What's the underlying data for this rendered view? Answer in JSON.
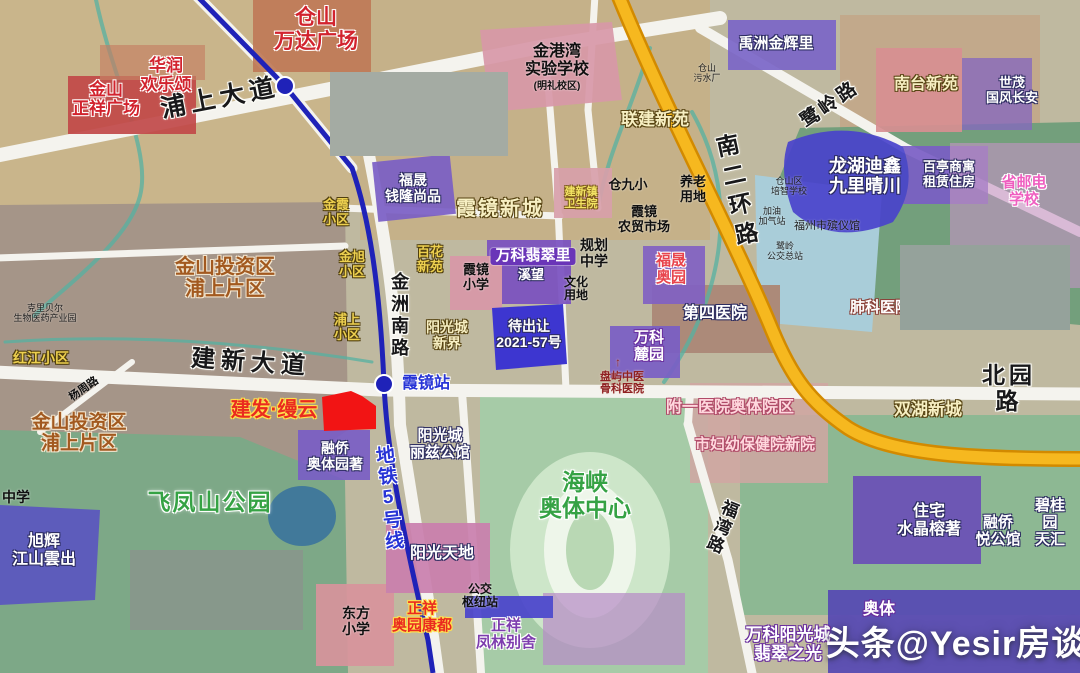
{
  "map": {
    "watermark": "头条@Yesir房谈",
    "colors": {
      "ring_road_orange": "#f6b81f",
      "metro_line_blue": "#1f22b8",
      "highlight_parcel_red": "#f21414",
      "auction_parcel_blue": "#3d36d0"
    },
    "labels": [
      {
        "name": "road-label-pushang-avenue",
        "text": "浦上大道",
        "x": 220,
        "y": 84,
        "size": 25,
        "style": "road",
        "rot": -11,
        "sp": 5
      },
      {
        "name": "road-label-jianxin-avenue",
        "text": "建新大道",
        "x": 251,
        "y": 350,
        "size": 24,
        "style": "road",
        "rot": 4,
        "sp": 6
      },
      {
        "name": "road-label-beiyuan",
        "text": "北园路",
        "x": 1009,
        "y": 363,
        "size": 23,
        "style": "road",
        "sp": 4
      },
      {
        "name": "road-label-luling",
        "text": "鹭岭路",
        "x": 830,
        "y": 94,
        "size": 19,
        "style": "road",
        "rot": -35,
        "sp": 3
      },
      {
        "name": "road-label-nanerhuan",
        "text": "南二环路",
        "x": 735,
        "y": 133,
        "size": 23,
        "style": "road",
        "vert": true,
        "rot": -12,
        "sp": 7
      },
      {
        "name": "road-label-jinzhou-south",
        "text": "金洲南路",
        "x": 399,
        "y": 272,
        "size": 18,
        "style": "road",
        "vert": true,
        "sp": 4
      },
      {
        "name": "road-label-fuwan",
        "text": "福湾路",
        "x": 721,
        "y": 498,
        "size": 17,
        "style": "road",
        "vert": true,
        "rot": 22,
        "sp": 2
      },
      {
        "name": "road-label-yangzhou",
        "text": "杨周路",
        "x": 84,
        "y": 383,
        "size": 11,
        "style": "blk",
        "rot": -35
      },
      {
        "name": "subway-label-line5",
        "text": "地铁5号线",
        "x": 388,
        "y": 445,
        "size": 19,
        "style": "blu",
        "vert": true,
        "rot": -6,
        "sp": 2
      },
      {
        "name": "station-label-xiajing",
        "text": "霞镜站",
        "x": 426,
        "y": 375,
        "size": 16,
        "style": "blu"
      },
      {
        "name": "label-cangshan-wanda-plaza",
        "text": "仓山\n万达广场",
        "x": 316,
        "y": 6,
        "size": 21,
        "style": "red"
      },
      {
        "name": "label-huarun-huanlesong",
        "text": "华润\n欢乐颂",
        "x": 166,
        "y": 56,
        "size": 17,
        "style": "red"
      },
      {
        "name": "label-jinshan-zhengxiang-plaza",
        "text": "金山\n正祥广场",
        "x": 106,
        "y": 80,
        "size": 17,
        "style": "red"
      },
      {
        "name": "label-jianfa-manyun",
        "text": "建发·缦云",
        "x": 274,
        "y": 399,
        "size": 20,
        "style": "jf"
      },
      {
        "name": "label-zhengxiang-aoyuan-kangdu",
        "text": "正祥\n奥园康都",
        "x": 422,
        "y": 601,
        "size": 15,
        "style": "jf"
      },
      {
        "name": "label-jingangwan-school",
        "text": "金港湾\n实验学校",
        "x": 557,
        "y": 43,
        "size": 16,
        "style": "blk"
      },
      {
        "name": "label-jingangwan-campus-note",
        "text": "(明礼校区)",
        "x": 557,
        "y": 81,
        "size": 10,
        "style": "blk"
      },
      {
        "name": "label-cangshan-sewage-plant",
        "text": "仓山\n污水厂",
        "x": 707,
        "y": 63,
        "size": 9,
        "style": "blkS"
      },
      {
        "name": "label-lianjian-xinyuan",
        "text": "联建新苑",
        "x": 655,
        "y": 110,
        "size": 17,
        "style": "cream"
      },
      {
        "name": "label-yuzhou-jinhuili",
        "text": "禹洲金辉里",
        "x": 776,
        "y": 36,
        "size": 15,
        "style": "wt"
      },
      {
        "name": "label-nantai-xinyuan",
        "text": "南台新苑",
        "x": 926,
        "y": 76,
        "size": 16,
        "style": "cream"
      },
      {
        "name": "label-shimao-guofengchangan",
        "text": "世茂\n国风长安",
        "x": 1012,
        "y": 76,
        "size": 13,
        "style": "wt"
      },
      {
        "name": "label-longhu-jiulijingchuan",
        "text": "龙湖迪鑫\n九里晴川",
        "x": 865,
        "y": 156,
        "size": 18,
        "style": "wt"
      },
      {
        "name": "label-baiting-rental-housing",
        "text": "百亭商寓\n租赁住房",
        "x": 949,
        "y": 160,
        "size": 13,
        "style": "wt"
      },
      {
        "name": "label-shengyoudian-school",
        "text": "省邮电学校",
        "x": 1024,
        "y": 175,
        "size": 15,
        "style": "pnk"
      },
      {
        "name": "label-peizhi-school",
        "text": "仓山区\n培智学校",
        "x": 789,
        "y": 176,
        "size": 9,
        "style": "blkS"
      },
      {
        "name": "label-gas-station",
        "text": "加油\n加气站",
        "x": 772,
        "y": 206,
        "size": 9,
        "style": "blkS"
      },
      {
        "name": "label-funeral-home",
        "text": "福州市殡仪馆",
        "x": 827,
        "y": 220,
        "size": 11,
        "style": "blkS"
      },
      {
        "name": "label-luling-bus-terminal",
        "text": "鹭岭\n公交总站",
        "x": 785,
        "y": 241,
        "size": 9,
        "style": "blkS"
      },
      {
        "name": "label-feike-hospital",
        "text": "肺科医院",
        "x": 880,
        "y": 300,
        "size": 15,
        "style": "wtR"
      },
      {
        "name": "label-disi-hospital",
        "text": "第四医院",
        "x": 715,
        "y": 305,
        "size": 16,
        "style": "wt"
      },
      {
        "name": "label-fusheng-aoyuan",
        "text": "福晟\n奥园",
        "x": 671,
        "y": 253,
        "size": 15,
        "style": "dkr"
      },
      {
        "name": "label-wanke-luyuan",
        "text": "万科\n麓园",
        "x": 649,
        "y": 330,
        "size": 15,
        "style": "wtP"
      },
      {
        "name": "label-panyu-hospital-arrow",
        "text": "↑",
        "x": 618,
        "y": 356,
        "size": 12,
        "style": "dkr2"
      },
      {
        "name": "label-panyu-hospital",
        "text": "盘屿中医\n骨科医院",
        "x": 622,
        "y": 371,
        "size": 11,
        "style": "dkr2"
      },
      {
        "name": "label-fuyi-hospital-aoti",
        "text": "附一医院奥体院区",
        "x": 730,
        "y": 399,
        "size": 16,
        "style": "pnkL"
      },
      {
        "name": "label-shifuyou-hospital",
        "text": "市妇幼保健院新院",
        "x": 755,
        "y": 437,
        "size": 15,
        "style": "pnkL"
      },
      {
        "name": "label-shuanghu-xincheng",
        "text": "双湖新城",
        "x": 928,
        "y": 400,
        "size": 17,
        "style": "cream"
      },
      {
        "name": "label-zhuzhai-shuijingrongzhu",
        "text": "住宅\n水晶榕著",
        "x": 929,
        "y": 503,
        "size": 16,
        "style": "wt"
      },
      {
        "name": "label-rongqiao-yuegongguan",
        "text": "融侨\n悦公馆",
        "x": 998,
        "y": 515,
        "size": 15,
        "style": "wt"
      },
      {
        "name": "label-biguiyuan-tianhui",
        "text": "碧桂园\n天汇",
        "x": 1050,
        "y": 498,
        "size": 15,
        "style": "wt"
      },
      {
        "name": "label-aoti",
        "text": "奥体",
        "x": 879,
        "y": 601,
        "size": 16,
        "style": "wtP"
      },
      {
        "name": "label-wanke-feicuizhiguang",
        "text": "万科阳光城\n翡翠之光",
        "x": 788,
        "y": 625,
        "size": 17,
        "style": "wtP"
      },
      {
        "name": "label-haixia-aoti-center",
        "text": "海峡\n奥体中心",
        "x": 585,
        "y": 470,
        "size": 23,
        "style": "grn"
      },
      {
        "name": "label-yangguang-tiandi",
        "text": "阳光天地",
        "x": 442,
        "y": 545,
        "size": 16,
        "style": "wt"
      },
      {
        "name": "label-bus-hub",
        "text": "公交\n枢纽站",
        "x": 480,
        "y": 583,
        "size": 12,
        "style": "blk"
      },
      {
        "name": "label-zhengxiang-fenglin",
        "text": "正祥\n凤林别舍",
        "x": 506,
        "y": 618,
        "size": 15,
        "style": "purW"
      },
      {
        "name": "label-dongfang-primary",
        "text": "东方\n小学",
        "x": 356,
        "y": 606,
        "size": 14,
        "style": "blk"
      },
      {
        "name": "label-yangguang-lizi",
        "text": "阳光城\n丽兹公馆",
        "x": 440,
        "y": 428,
        "size": 15,
        "style": "wt"
      },
      {
        "name": "label-rongqiao-aotiyuanzhu",
        "text": "融侨\n奥体园著",
        "x": 335,
        "y": 441,
        "size": 14,
        "style": "wt"
      },
      {
        "name": "label-hongjiang-community",
        "text": "红江小区",
        "x": 41,
        "y": 351,
        "size": 14,
        "style": "yl"
      },
      {
        "name": "label-jinshan-investment-1",
        "text": "金山投资区\n浦上片区",
        "x": 225,
        "y": 256,
        "size": 20,
        "style": "brn"
      },
      {
        "name": "label-jinshan-investment-2",
        "text": "金山投资区\n浦上片区",
        "x": 79,
        "y": 412,
        "size": 19,
        "style": "brn"
      },
      {
        "name": "label-kelibeier-biopark",
        "text": "克里贝尔\n生物医药产业园",
        "x": 45,
        "y": 303,
        "size": 9,
        "style": "blkS"
      },
      {
        "name": "label-feifengshan-park",
        "text": "飞凤山公园",
        "x": 210,
        "y": 490,
        "size": 23,
        "style": "grn",
        "sp": 2
      },
      {
        "name": "label-xuhui-jiangshanyunchu",
        "text": "旭辉\n江山雲出",
        "x": 44,
        "y": 533,
        "size": 16,
        "style": "wt"
      },
      {
        "name": "label-middle-school-left",
        "text": "中学",
        "x": 16,
        "y": 490,
        "size": 14,
        "style": "blk"
      },
      {
        "name": "label-jinxia-community",
        "text": "金霞\n小区",
        "x": 336,
        "y": 198,
        "size": 13,
        "style": "yl"
      },
      {
        "name": "label-jinxu-community",
        "text": "金旭\n小区",
        "x": 352,
        "y": 250,
        "size": 13,
        "style": "yl"
      },
      {
        "name": "label-pushang-community",
        "text": "浦上\n小区",
        "x": 347,
        "y": 313,
        "size": 13,
        "style": "yl"
      },
      {
        "name": "label-fusheng-qianlong",
        "text": "福晟\n钱隆尚品",
        "x": 413,
        "y": 173,
        "size": 14,
        "style": "wt"
      },
      {
        "name": "label-baihua-community",
        "text": "百花\n新苑",
        "x": 430,
        "y": 245,
        "size": 13,
        "style": "yl"
      },
      {
        "name": "label-xiajing-primary",
        "text": "霞镜\n小学",
        "x": 476,
        "y": 263,
        "size": 13,
        "style": "blk"
      },
      {
        "name": "label-xiajing-xincheng",
        "text": "霞镜新城",
        "x": 500,
        "y": 198,
        "size": 20,
        "style": "cream",
        "sp": 2
      },
      {
        "name": "label-jianxinzhen-clinic",
        "text": "建新镇\n卫生院",
        "x": 581,
        "y": 186,
        "size": 11,
        "style": "ylS"
      },
      {
        "name": "label-wanke-feicuili",
        "text": "万科翡翠里",
        "x": 533,
        "y": 248,
        "size": 15,
        "style": "pill"
      },
      {
        "name": "label-xiwang",
        "text": "溪望",
        "x": 531,
        "y": 268,
        "size": 13,
        "style": "wt"
      },
      {
        "name": "label-planned-middle-school",
        "text": "规划\n中学",
        "x": 594,
        "y": 238,
        "size": 14,
        "style": "blk"
      },
      {
        "name": "label-culture-land",
        "text": "文化\n用地",
        "x": 576,
        "y": 276,
        "size": 12,
        "style": "blk"
      },
      {
        "name": "label-cangjiuxiao-school",
        "text": "仓九小",
        "x": 628,
        "y": 178,
        "size": 13,
        "style": "blk"
      },
      {
        "name": "label-elderly-care-land",
        "text": "养老\n用地",
        "x": 693,
        "y": 175,
        "size": 13,
        "style": "blk"
      },
      {
        "name": "label-xiajing-farmers-market",
        "text": "霞镜\n农贸市场",
        "x": 644,
        "y": 205,
        "size": 13,
        "style": "blk"
      },
      {
        "name": "label-yangguang-xinjie",
        "text": "阳光城\n新界",
        "x": 447,
        "y": 320,
        "size": 14,
        "style": "cream"
      },
      {
        "name": "label-daichurang-parcel",
        "text": "待出让\n2021-57号",
        "x": 529,
        "y": 319,
        "size": 14,
        "style": "wt"
      }
    ]
  }
}
